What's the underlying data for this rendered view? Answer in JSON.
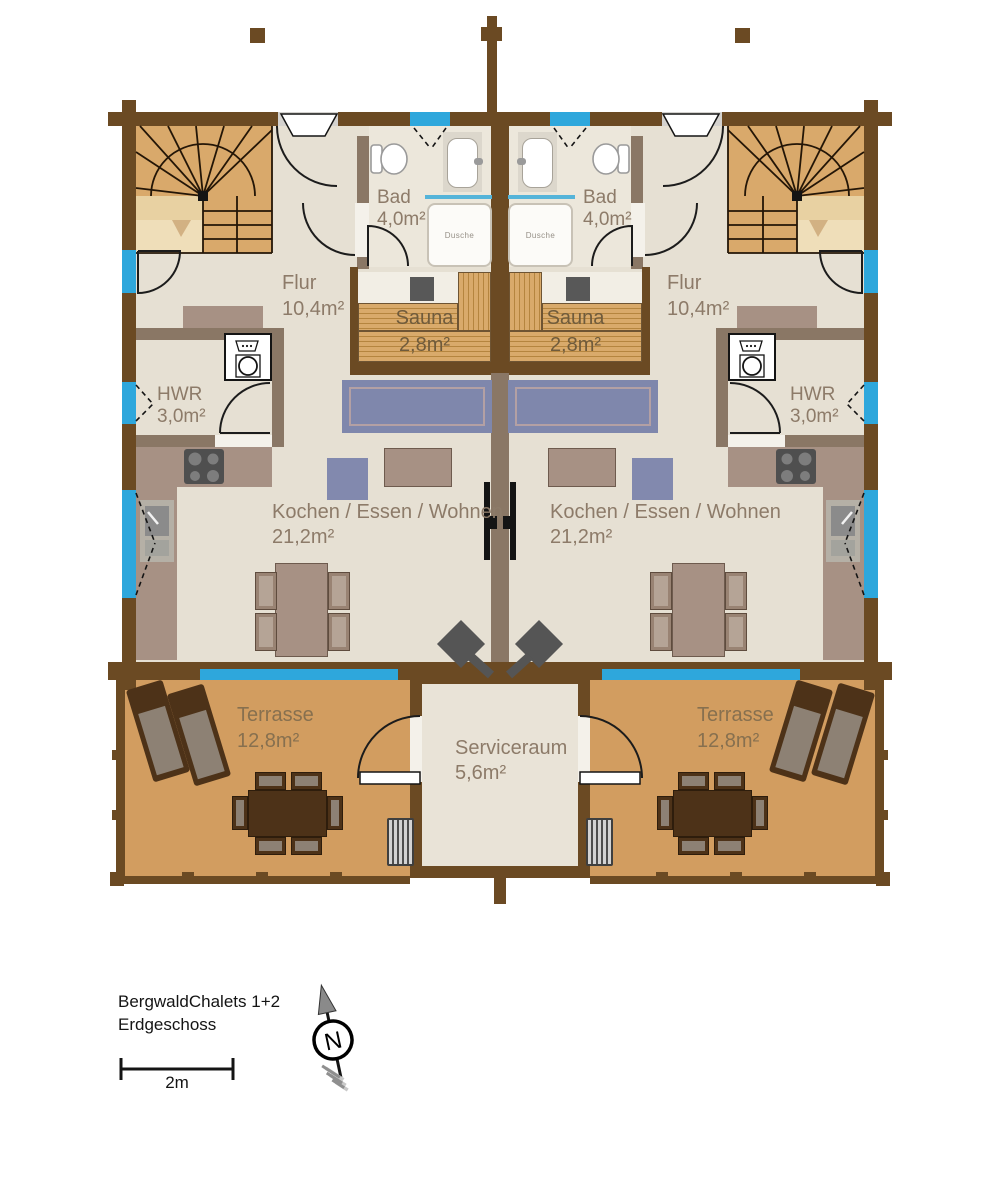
{
  "plan": {
    "title_line1": "BergwaldChalets 1+2",
    "title_line2": "Erdgeschoss",
    "scale_label": "2m",
    "compass_label": "N"
  },
  "colors": {
    "exterior_wall": "#6b4a23",
    "partition_wall": "#8a7765",
    "floor": "#e6e0d3",
    "terrace_wood": "#d29d60",
    "stair_wood": "#d9a96b",
    "window_blue": "#2ea7dc",
    "sofa_blue": "#7f87ac",
    "furniture_taupe": "#a79184",
    "terrace_furniture": "#4d3218"
  },
  "chalet_left": {
    "flur": {
      "name": "Flur",
      "area": "10,4m²"
    },
    "bad": {
      "name": "Bad",
      "area": "4,0m²"
    },
    "dusche": "Dusche",
    "sauna": {
      "name": "Sauna",
      "area": "2,8m²"
    },
    "hwr": {
      "name": "HWR",
      "area": "3,0m²"
    },
    "wohnen": {
      "name": "Kochen / Essen / Wohnen",
      "area": "21,2m²"
    },
    "terrasse": {
      "name": "Terrasse",
      "area": "12,8m²"
    }
  },
  "chalet_right": {
    "flur": {
      "name": "Flur",
      "area": "10,4m²"
    },
    "bad": {
      "name": "Bad",
      "area": "4,0m²"
    },
    "dusche": "Dusche",
    "sauna": {
      "name": "Sauna",
      "area": "2,8m²"
    },
    "hwr": {
      "name": "HWR",
      "area": "3,0m²"
    },
    "wohnen": {
      "name": "Kochen / Essen / Wohnen",
      "area": "21,2m²"
    },
    "terrasse": {
      "name": "Terrasse",
      "area": "12,8m²"
    }
  },
  "serviceraum": {
    "name": "Serviceraum",
    "area": "5,6m²"
  }
}
